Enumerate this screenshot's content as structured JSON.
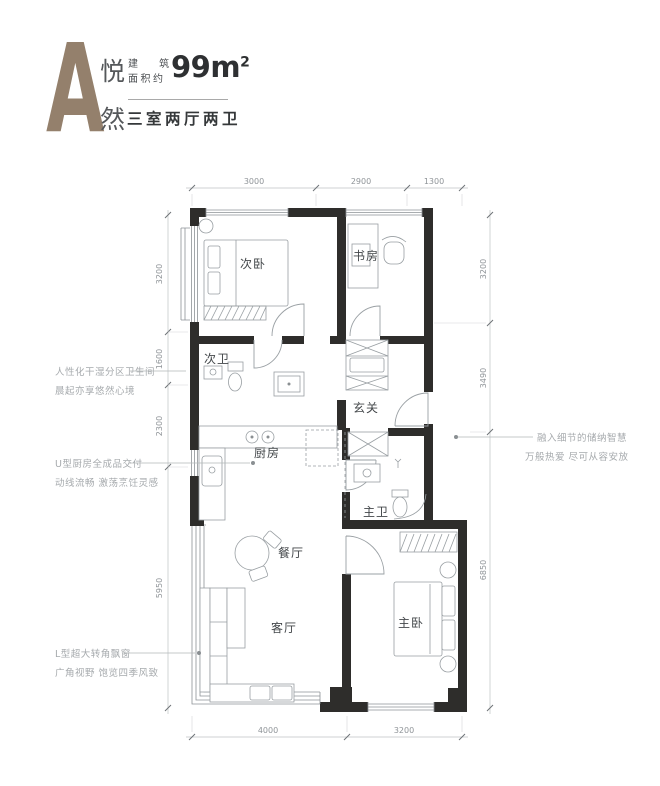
{
  "header": {
    "block_letter": "A",
    "name_char_1": "悦",
    "name_char_2": "然",
    "area_prefix_line1": "建 筑",
    "area_prefix_line2": "面积约",
    "area_value": "99m",
    "area_superscript": "2",
    "layout_summary": "三室两厅两卫"
  },
  "rooms": {
    "secondary_bedroom": "次卧",
    "study": "书房",
    "secondary_bath": "次卫",
    "foyer": "玄关",
    "kitchen": "厨房",
    "master_bath": "主卫",
    "dining": "餐厅",
    "living": "客厅",
    "master_bedroom": "主卧"
  },
  "dimensions": {
    "top": [
      "3000",
      "2900",
      "1300"
    ],
    "left": [
      "3200",
      "1600",
      "2300",
      "5950"
    ],
    "right": [
      "3200",
      "3490",
      "6850"
    ],
    "bottom": [
      "4000",
      "3200"
    ]
  },
  "annotations": {
    "bath_line1": "人性化干湿分区卫生间",
    "bath_line2": "晨起亦享悠然心境",
    "kitchen_line1": "U型厨房全成品交付",
    "kitchen_line2": "动线流畅  激荡烹饪灵感",
    "bay_line1": "L型超大转角飘窗",
    "bay_line2": "广角视野  饱览四季风致",
    "storage_line1": "融入细节的储纳智慧",
    "storage_line2": "万般热爱  尽可从容安放"
  },
  "colors": {
    "wall": "#2e2d2b",
    "accent_letter": "#94806c",
    "annotation": "#a6aaad",
    "dim_text": "#8f9498",
    "title_text": "#2e3032"
  }
}
